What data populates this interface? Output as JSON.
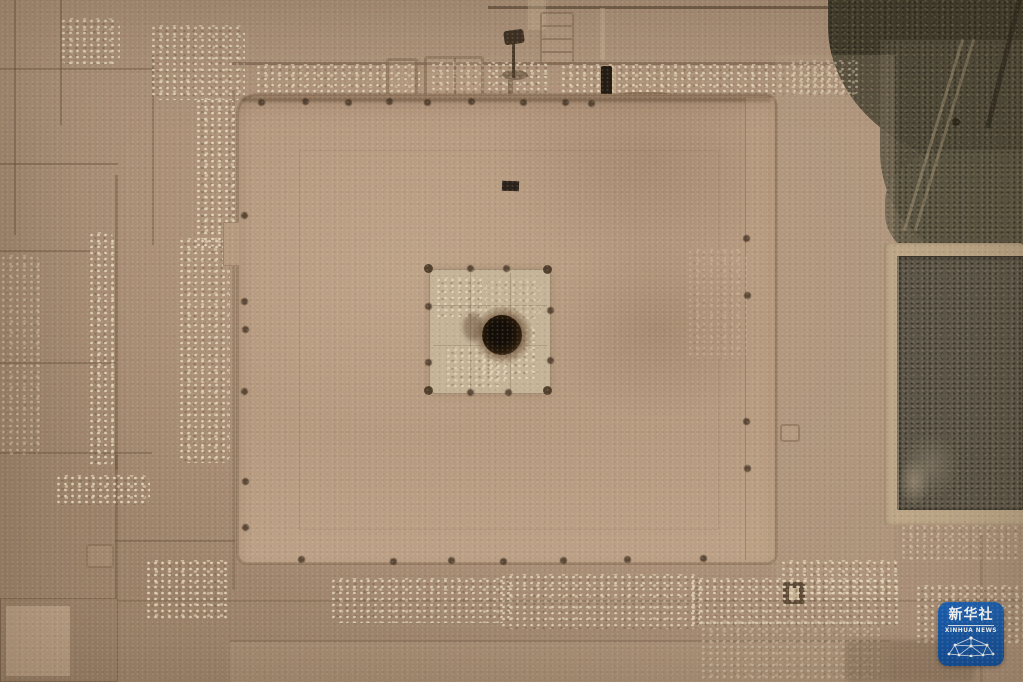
{
  "scene": {
    "type": "aerial drone photograph, top-down",
    "subject": "archaeological excavation of a large square rammed-earth platform with central square altar pit and dark circular well, surrounded by excavation trenches and balks",
    "width_px": 1023,
    "height_px": 682
  },
  "palette": {
    "ground": "#ab9078",
    "ground_light": "#b89d83",
    "ground_dark": "#9c8269",
    "platform": "#b69a80",
    "platform_light": "#c3a98e",
    "rubble": "#d8c9ad",
    "trench_line": "#6e573f",
    "central_fill": "#c4b397",
    "post": "#463424",
    "pit_core": "#130d07",
    "pit_ring": "#3f2d1c",
    "pit_halo": "#7a5f45",
    "shadow_bar": "#221b13",
    "veg_dark": "#403c2c",
    "veg_mid": "#524c3b",
    "field": "#5f584a",
    "field_light": "#767d6c",
    "path": "#bca687",
    "watermark_bg": "#0e4e9e",
    "watermark_text": "#ffffff"
  },
  "watermark": {
    "name": "Xinhua News app logo",
    "title": "新华社",
    "subtitle": "XINHUA NEWS",
    "icon": "network-globe-icon"
  }
}
